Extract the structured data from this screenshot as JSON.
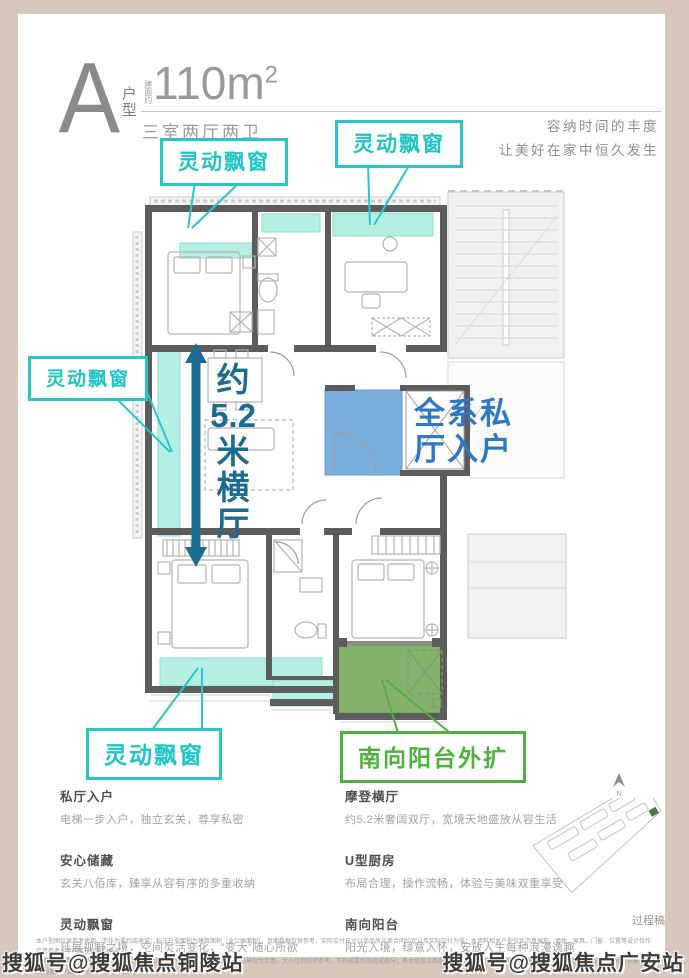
{
  "header": {
    "unit_letter": "A",
    "unit_label": "户型",
    "area_prefix": "建面约",
    "area_value": "110m",
    "area_sup": "2",
    "rooms": "三室两厅两卫",
    "tagline_line1": "容纳时间的丰度",
    "tagline_line2": "让美好在家中恒久发生"
  },
  "plan": {
    "callouts": {
      "bay_window": "灵动飘窗",
      "balcony": "南向阳台外扩",
      "entry_line1": "全系私",
      "entry_line2": "厅入户",
      "hall_chars": [
        "约",
        "5.2",
        "米",
        "横",
        "厅"
      ]
    },
    "compass": "N",
    "colors": {
      "teal": "#29c6c7",
      "teal_fill": "#b5efe4",
      "dark_teal": "#1d6b8e",
      "blue": "#2e79c2",
      "blue_fill": "#6ba3d9",
      "green": "#4fb23e",
      "green_fill": "#77a95c"
    }
  },
  "features": {
    "left": [
      {
        "title": "私厅入户",
        "desc": "电梯一步入户，独立玄关，尊享私密"
      },
      {
        "title": "安心储藏",
        "desc": "玄关八佰库，臻享从容有序的多重收纳"
      },
      {
        "title": "灵动飘窗",
        "desc": "延展视野之境，空间灵活变化，“变大”随心所欲"
      }
    ],
    "right": [
      {
        "title": "摩登横厅",
        "desc": "约5.2米奢阔双厅，宽境天地盛放从容生活"
      },
      {
        "title": "U型厨房",
        "desc": "布局合理，操作流畅，体验与美味双重享受"
      },
      {
        "title": "南向阳台",
        "desc": "阳光入境，绿意入怀，安放人生每种浪漫逸趣"
      }
    ]
  },
  "footer": {
    "process_note": "过程稿",
    "disclaimer_line1": "本户型图仅供参考使用，不作为要约或承诺；标注户型面积为建筑面积（含公摊面积），页面数据仅供参考，实际交付尺寸以商品房买卖合同约定以及实际交付为准；本资料相关户型仅作示意展现，墙体、家具、门窗、位置等设计仅作示意参考，不构成任何要约承诺。",
    "disclaimer_line2": "图中所示户型结构以商品房买卖合同约定以及实际交付为准；本户型装修陈设场景仅为示意，大小比例仅供参考，不构成要约的组成部分；具体信息以商品房实际交付约定以及实际交付为准。广审号【详见售楼处】，备案号【预售证2025房地产第00036号】，详询【上海】",
    "watermark_left": "搜狐号@搜狐焦点铜陵站",
    "watermark_right": "搜狐号@搜狐焦点广安站"
  }
}
